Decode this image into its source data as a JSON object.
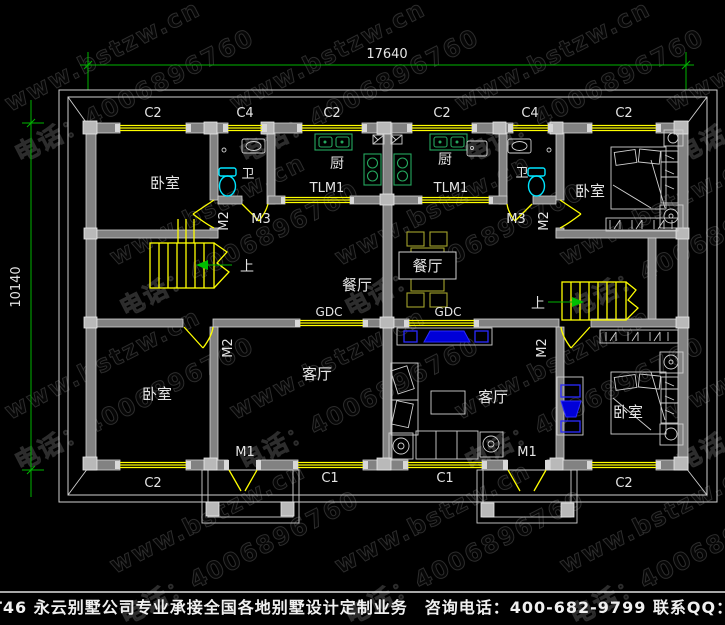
{
  "watermark": {
    "site": "www.bstzw.cn",
    "phone": "电话：4006896760"
  },
  "dimensions": {
    "width": "17640",
    "height": "10140"
  },
  "rooms": {
    "bedroom": "卧室",
    "kitchen": "厨",
    "bathroom": "卫",
    "dining": "餐厅",
    "living": "客厅",
    "up": "上"
  },
  "openings": {
    "entry_door": "M1",
    "bedroom_door": "M2",
    "bath_door": "M3",
    "kitchen_sliding_door": "TLM1",
    "partition": "GDC",
    "window_c1": "C1",
    "window_c2": "C2",
    "window_c4": "C4"
  },
  "footer": {
    "text": "本图编号：AT46 永云别墅公司专业承接全国各地别墅设计定制业务　咨询电话：400-682-9799 联系QQ：83095318"
  },
  "colors": {
    "background": "#000000",
    "wall": "#828282",
    "window": "#ffff00",
    "dimension": "#00b400",
    "label": "#e4e4e4",
    "sanitary": "#00e5ff",
    "kitchen_counter": "#25a85e",
    "furniture_blue": "#2a2aff",
    "dining_set": "#a3a32b"
  }
}
